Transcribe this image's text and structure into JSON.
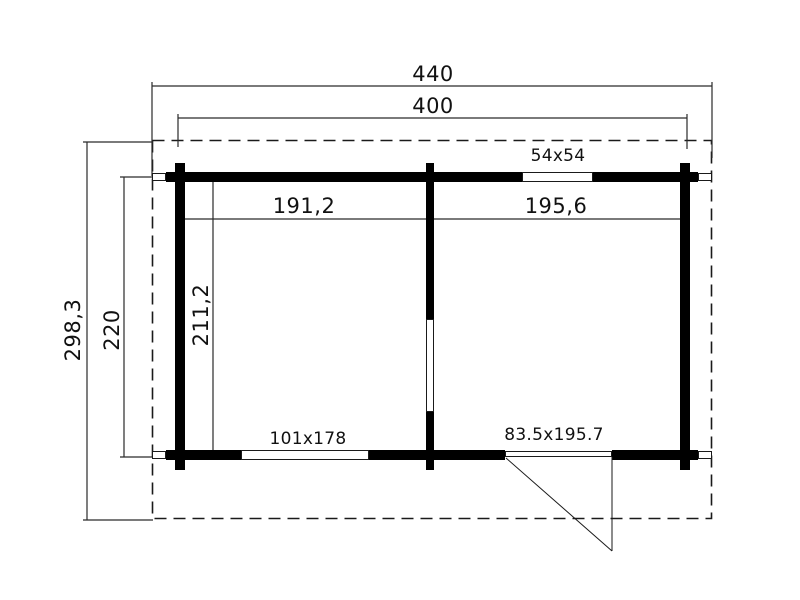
{
  "drawing": {
    "type": "floor-plan",
    "colors": {
      "background": "#ffffff",
      "wall_fill": "#000000",
      "line": "#1a1a1a",
      "text": "#111111"
    },
    "dimensions": {
      "overall_width": "440",
      "wall_outer_width": "400",
      "overall_depth": "298,3",
      "wall_outer_depth": "220",
      "room_inner_depth": "211,2",
      "left_room_width": "191,2",
      "right_room_width": "195,6"
    },
    "openings": {
      "top_window": "54x54",
      "bottom_window": "101x178",
      "entry_door": "83.5x195.7"
    }
  }
}
